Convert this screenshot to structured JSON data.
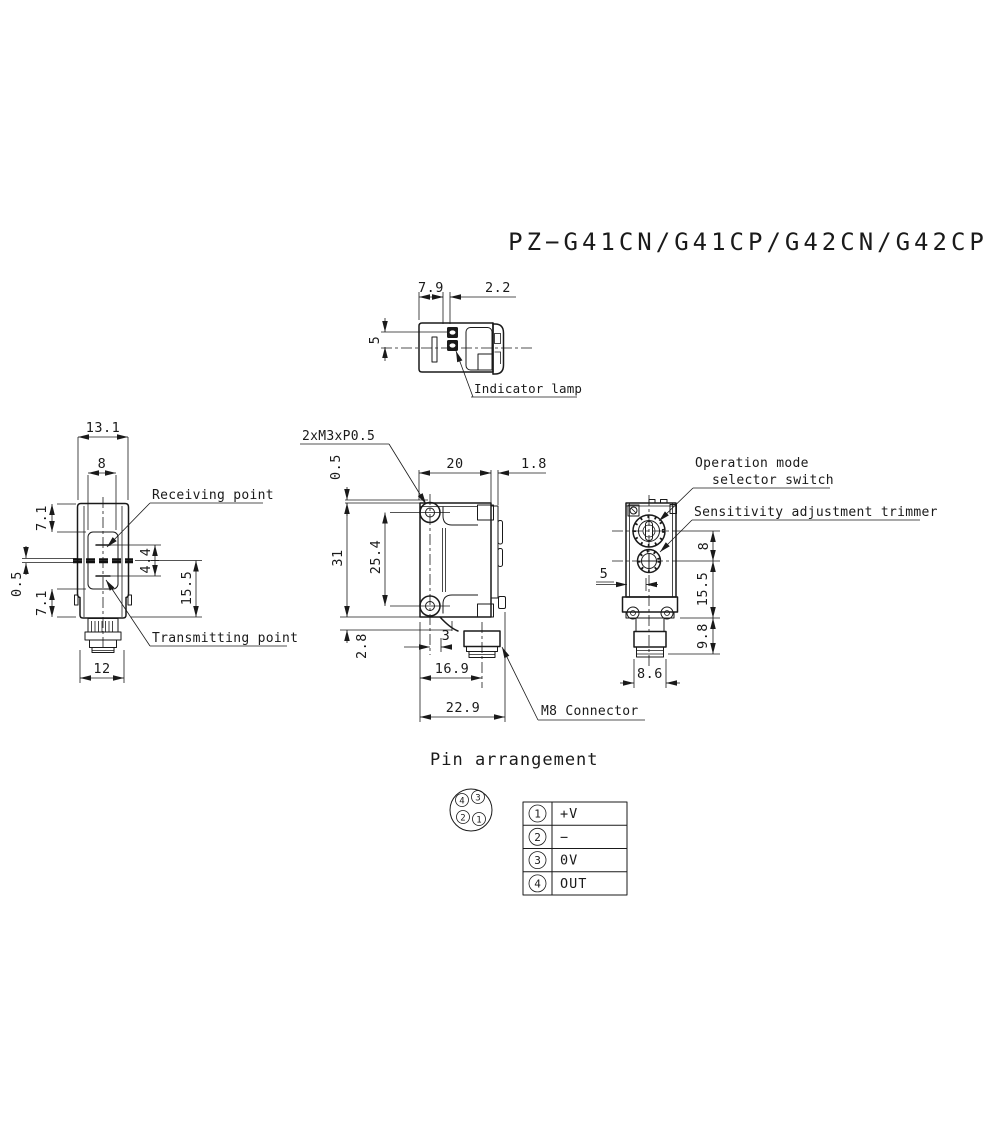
{
  "title": "PZ−G41CN/G41CP/G42CN/G42CP",
  "views": {
    "top": {
      "dim_width_left": "7.9",
      "dim_width_right": "2.2",
      "dim_height": "5",
      "indicator_label": "Indicator lamp"
    },
    "front": {
      "dim_total_width": "13.1",
      "dim_window_width": "8",
      "dim_upper": "7.1",
      "dim_offset": "0.5",
      "dim_lower": "7.1",
      "dim_beam_spacing": "4.4",
      "dim_lower_height": "15.5",
      "dim_bottom_width": "12",
      "receiving_label": "Receiving point",
      "transmitting_label": "Transmitting point"
    },
    "side": {
      "thread_label": "2xM3xP0.5",
      "dim_offset_top": "0.5",
      "dim_top_width": "20",
      "dim_lens_depth": "1.8",
      "dim_height": "31",
      "dim_hole_pitch": "25.4",
      "dim_step": "2.8",
      "dim_conn_offset": "3",
      "dim_conn_center": "16.9",
      "dim_total_depth": "22.9",
      "connector_label": "M8 Connector"
    },
    "rear": {
      "dim_center_offset": "5",
      "dim_dial_pitch": "8",
      "dim_lower_height": "15.5",
      "dim_conn_height": "9.8",
      "dim_conn_width": "8.6",
      "switch_label_line1": "Operation mode",
      "switch_label_line2": "selector switch",
      "trimmer_label": "Sensitivity adjustment trimmer"
    }
  },
  "pin_arrangement": {
    "heading": "Pin arrangement",
    "pins": [
      {
        "num": "1",
        "label": "+V"
      },
      {
        "num": "2",
        "label": "−"
      },
      {
        "num": "3",
        "label": "0V"
      },
      {
        "num": "4",
        "label": "OUT"
      }
    ]
  }
}
